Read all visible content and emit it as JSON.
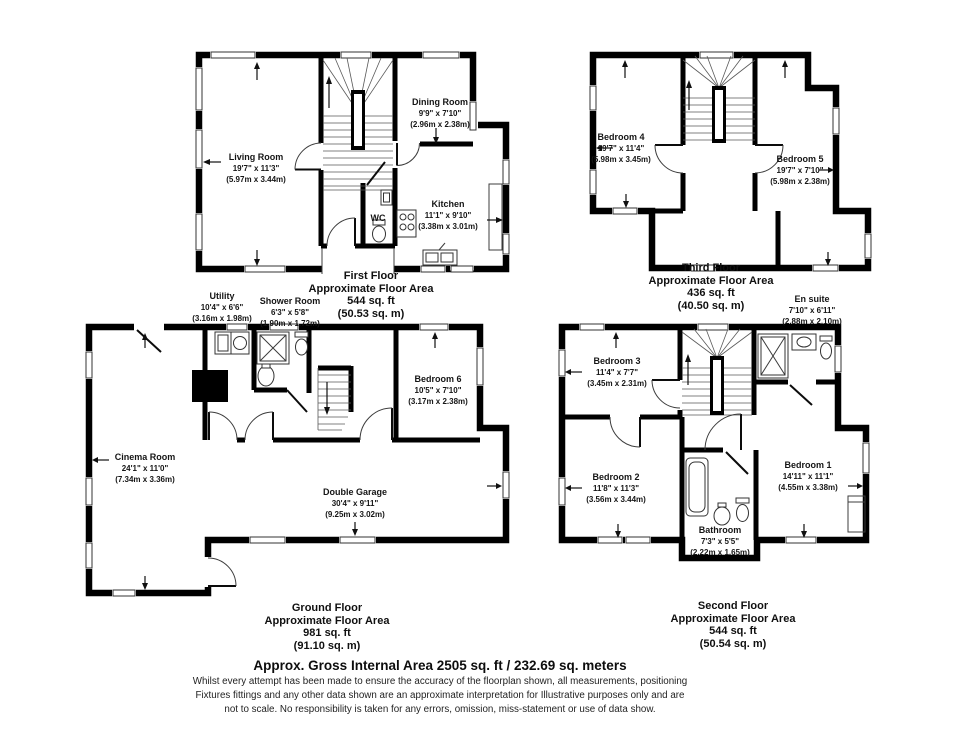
{
  "document": {
    "footer": {
      "headline": "Approx. Gross Internal Area 2505 sq. ft / 232.69 sq. meters",
      "disclaimer1": "Whilst every attempt has been made to ensure the accuracy of the floorplan shown, all measurements, positioning",
      "disclaimer2": "Fixtures fittings and any other data shown are an approximate interpretation for Illustrative purposes only  and are",
      "disclaimer3": "not to scale. No responsibility is taken for any errors, omission, miss-statement or use of data show."
    }
  },
  "floors": {
    "first": {
      "title": "First Floor",
      "subtitle": "Approximate Floor Area",
      "area_imperial": "544 sq. ft",
      "area_metric": "(50.53 sq. m)",
      "rooms": {
        "living_room": {
          "name": "Living Room",
          "imperial": "19'7\" x 11'3\"",
          "metric": "(5.97m x 3.44m)"
        },
        "dining_room": {
          "name": "Dining Room",
          "imperial": "9'9\" x 7'10\"",
          "metric": "(2.96m x 2.38m)"
        },
        "kitchen": {
          "name": "Kitchen",
          "imperial": "11'1\" x 9'10\"",
          "metric": "(3.38m x 3.01m)"
        },
        "wc": {
          "name": "WC"
        }
      }
    },
    "third": {
      "title": "Third Floor",
      "subtitle": "Approximate Floor Area",
      "area_imperial": "436 sq. ft",
      "area_metric": "(40.50 sq. m)",
      "rooms": {
        "bedroom4": {
          "name": "Bedroom 4",
          "imperial": "19'7\" x 11'4\"",
          "metric": "(5.98m x 3.45m)"
        },
        "bedroom5": {
          "name": "Bedroom 5",
          "imperial": "19'7\" x 7'10\"",
          "metric": "(5.98m x 2.38m)"
        }
      }
    },
    "ground": {
      "title": "Ground Floor",
      "subtitle": "Approximate Floor Area",
      "area_imperial": "981 sq. ft",
      "area_metric": "(91.10 sq. m)",
      "rooms": {
        "utility": {
          "name": "Utility",
          "imperial": "10'4\" x 6'6\"",
          "metric": "(3.16m x 1.98m)"
        },
        "shower_room": {
          "name": "Shower Room",
          "imperial": "6'3\" x 5'8\"",
          "metric": "(1.90m x 1.72m)"
        },
        "cinema_room": {
          "name": "Cinema Room",
          "imperial": "24'1\" x 11'0\"",
          "metric": "(7.34m x 3.36m)"
        },
        "bedroom6": {
          "name": "Bedroom 6",
          "imperial": "10'5\" x 7'10\"",
          "metric": "(3.17m x 2.38m)"
        },
        "double_garage": {
          "name": "Double Garage",
          "imperial": "30'4\" x 9'11\"",
          "metric": "(9.25m x 3.02m)"
        }
      }
    },
    "second": {
      "title": "Second Floor",
      "subtitle": "Approximate Floor Area",
      "area_imperial": "544 sq. ft",
      "area_metric": "(50.54 sq. m)",
      "rooms": {
        "en_suite": {
          "name": "En suite",
          "imperial": "7'10\" x 6'11\"",
          "metric": "(2.88m x 2.10m)"
        },
        "bedroom3": {
          "name": "Bedroom 3",
          "imperial": "11'4\" x 7'7\"",
          "metric": "(3.45m x 2.31m)"
        },
        "bedroom2": {
          "name": "Bedroom 2",
          "imperial": "11'8\" x 11'3\"",
          "metric": "(3.56m x 3.44m)"
        },
        "bedroom1": {
          "name": "Bedroom 1",
          "imperial": "14'11\" x 11'1\"",
          "metric": "(4.55m x 3.38m)"
        },
        "bathroom": {
          "name": "Bathroom",
          "imperial": "7'3\" x 5'5\"",
          "metric": "(2.22m x 1.65m)"
        }
      }
    }
  }
}
